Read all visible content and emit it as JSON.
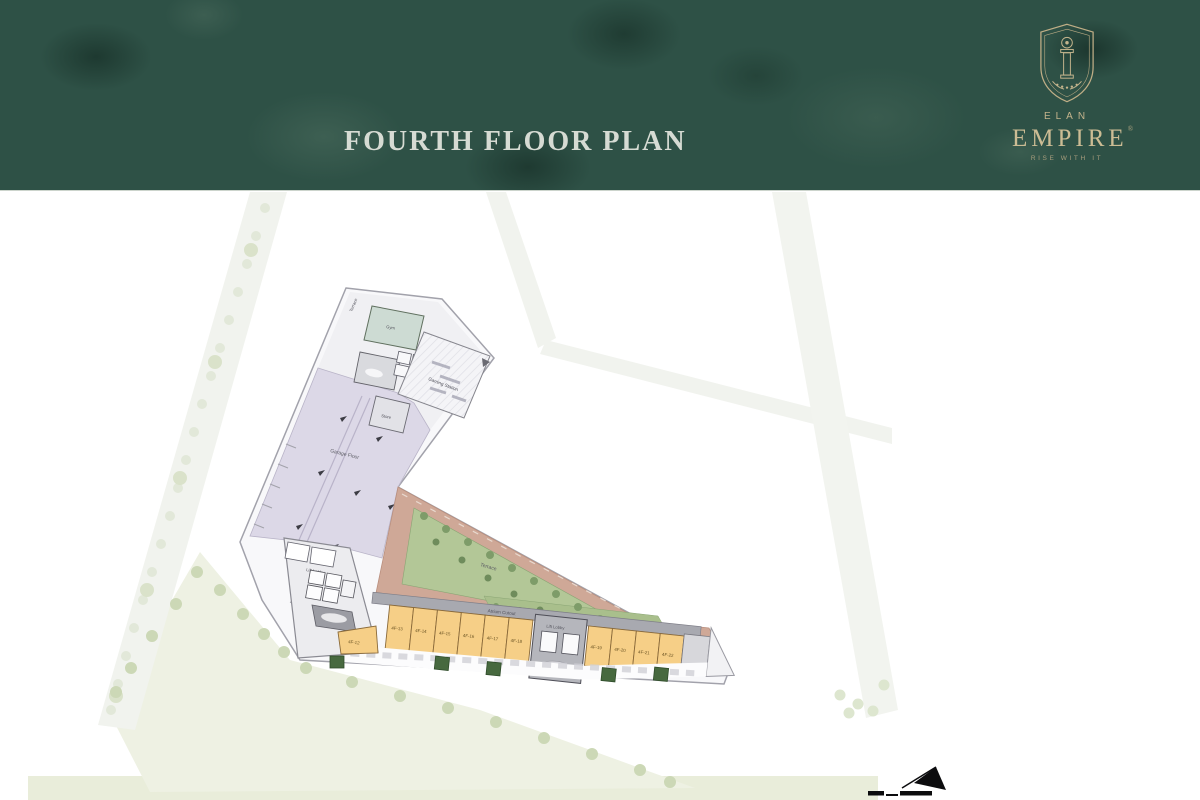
{
  "header": {
    "title": "FOURTH FLOOR PLAN",
    "logo": {
      "brand_top": "ELAN",
      "brand_main": "EMPIRE",
      "trademark": "®",
      "tagline": "RISE WITH IT"
    }
  },
  "plan": {
    "labels": {
      "hall": "Garage Floor",
      "terrace": "Terrace",
      "west_terrace": "Terrace",
      "gym": "Gym",
      "gaming_station": "Gaming Station",
      "store": "Store",
      "atrium": "Atrium Cutout",
      "lift_lobby": "Lift Lobby",
      "core_lift_lobby": "Lift Lobby"
    },
    "units": {
      "left": [
        "4F-13",
        "4F-14",
        "4F-15",
        "4F-16",
        "4F-17",
        "4F-18"
      ],
      "right": [
        "4F-19",
        "4F-20",
        "4F-21",
        "4F-22"
      ],
      "corner": "4F-12"
    },
    "colors": {
      "header_green": "#2e5146",
      "brand_gold": "#c6b68e",
      "unit_orange": "#f6cf87",
      "terrace_tan": "#cfa897",
      "landscape_green": "#a9bf8c",
      "hall_lavender": "#dcd8e7",
      "wall_gray": "#9a9aa2"
    }
  }
}
